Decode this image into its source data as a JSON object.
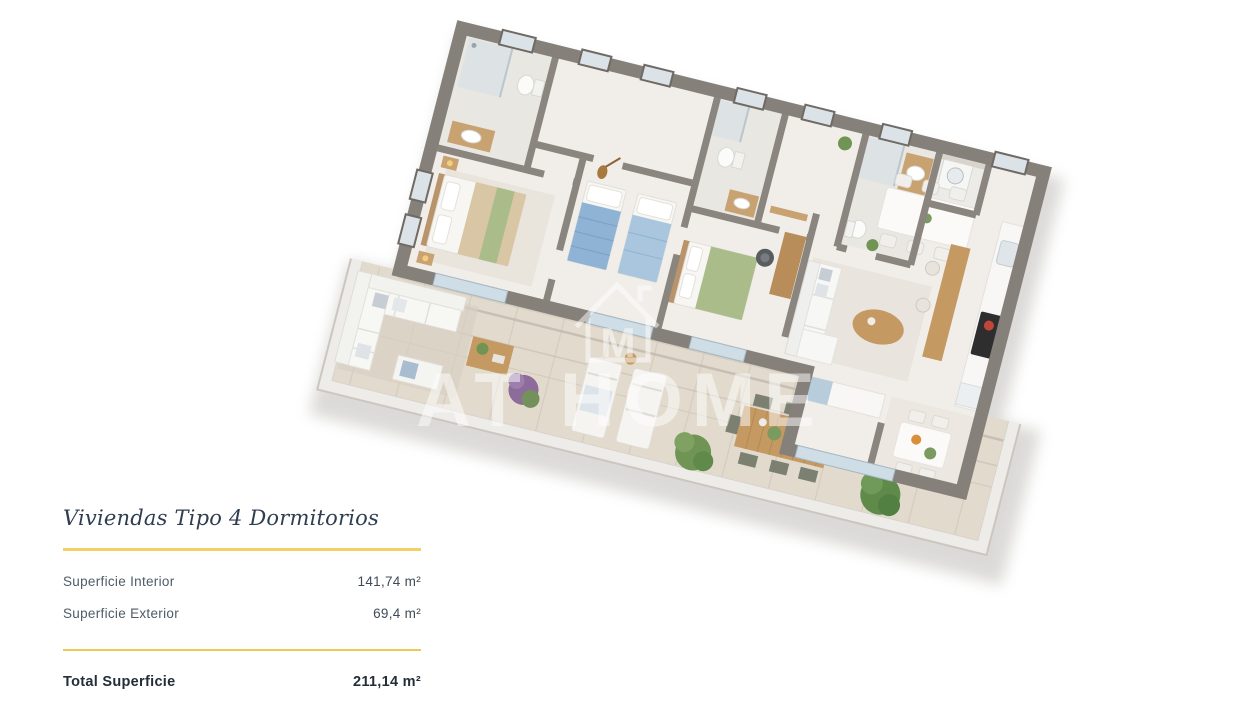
{
  "plan": {
    "title": "Viviendas Tipo 4 Dormitorios",
    "areas": [
      {
        "label": "Superficie Interior",
        "value": "141,74 m²"
      },
      {
        "label": "Superficie Exterior",
        "value": "69,4 m²"
      }
    ],
    "total": {
      "label": "Total Superficie",
      "value": "211,14 m²"
    }
  },
  "watermark": {
    "brand": "AT HOME",
    "logo_letter": "M"
  },
  "colors": {
    "accent_line": "#F2D166",
    "title_text": "#2F3E50",
    "label_text": "#4F5B66",
    "value_text": "#3F4B57",
    "total_text": "#232E39",
    "wall": "#85807A",
    "interior_floor": "#F1EEE9",
    "bathroom_floor": "#E9E7E2",
    "terrace_floor": "#E2DACD",
    "bed_green": "#A9BC8A",
    "bed_blue": "#8FB3D4",
    "wood": "#C49A62",
    "plant_green": "#6F9454",
    "watermark": "#FFFFFF"
  }
}
